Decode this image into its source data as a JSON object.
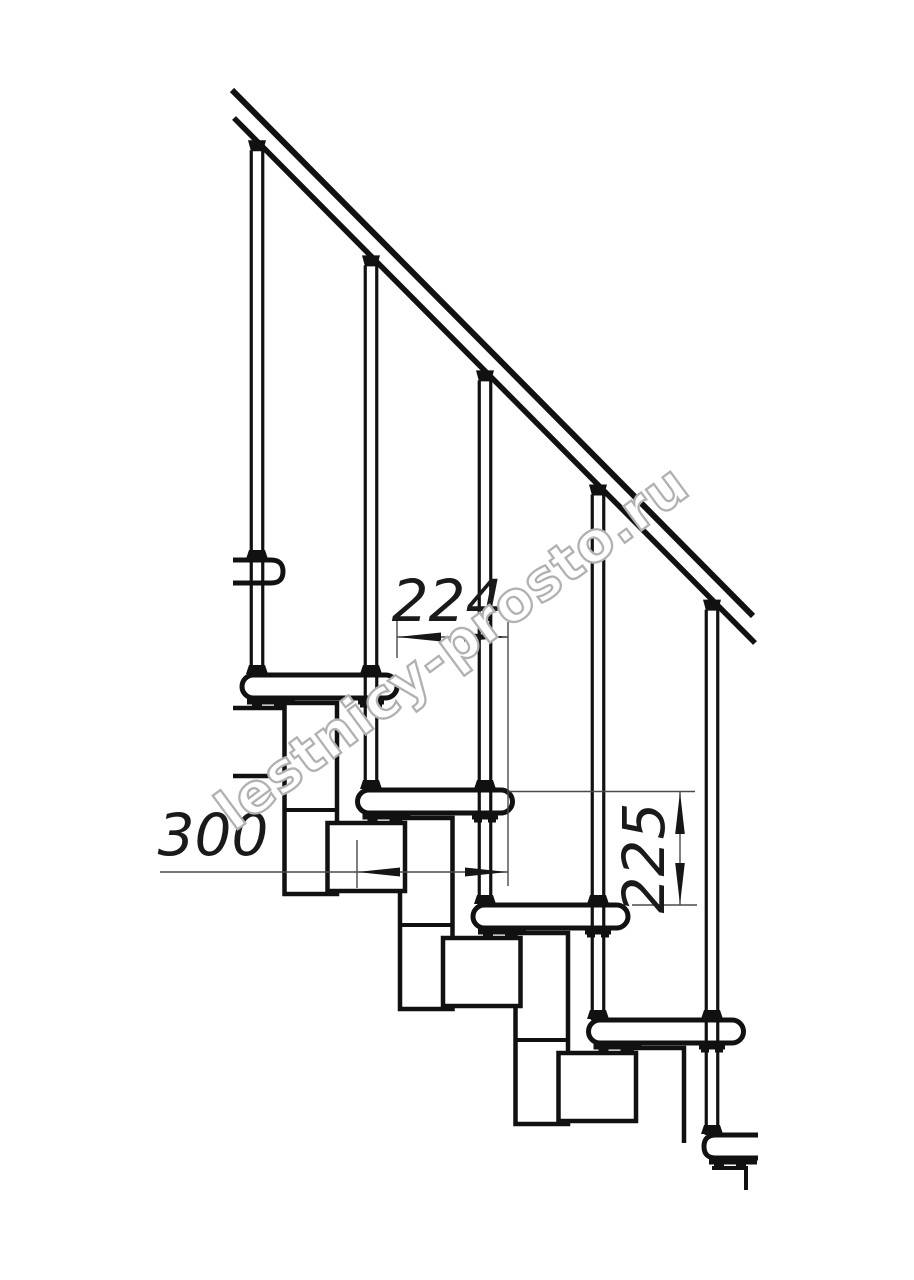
{
  "watermark": {
    "text": "lestnicy-prosto.ru"
  },
  "dimensions": {
    "going_between_steps": "224",
    "step_length": "300",
    "step_rise": "225"
  },
  "colors": {
    "background": "#ffffff",
    "line": "#111111",
    "thin_line": "#4a4a4a",
    "arrow": "#161616",
    "text": "#1a1a1a",
    "watermark_outline": "#b1b1b1"
  }
}
